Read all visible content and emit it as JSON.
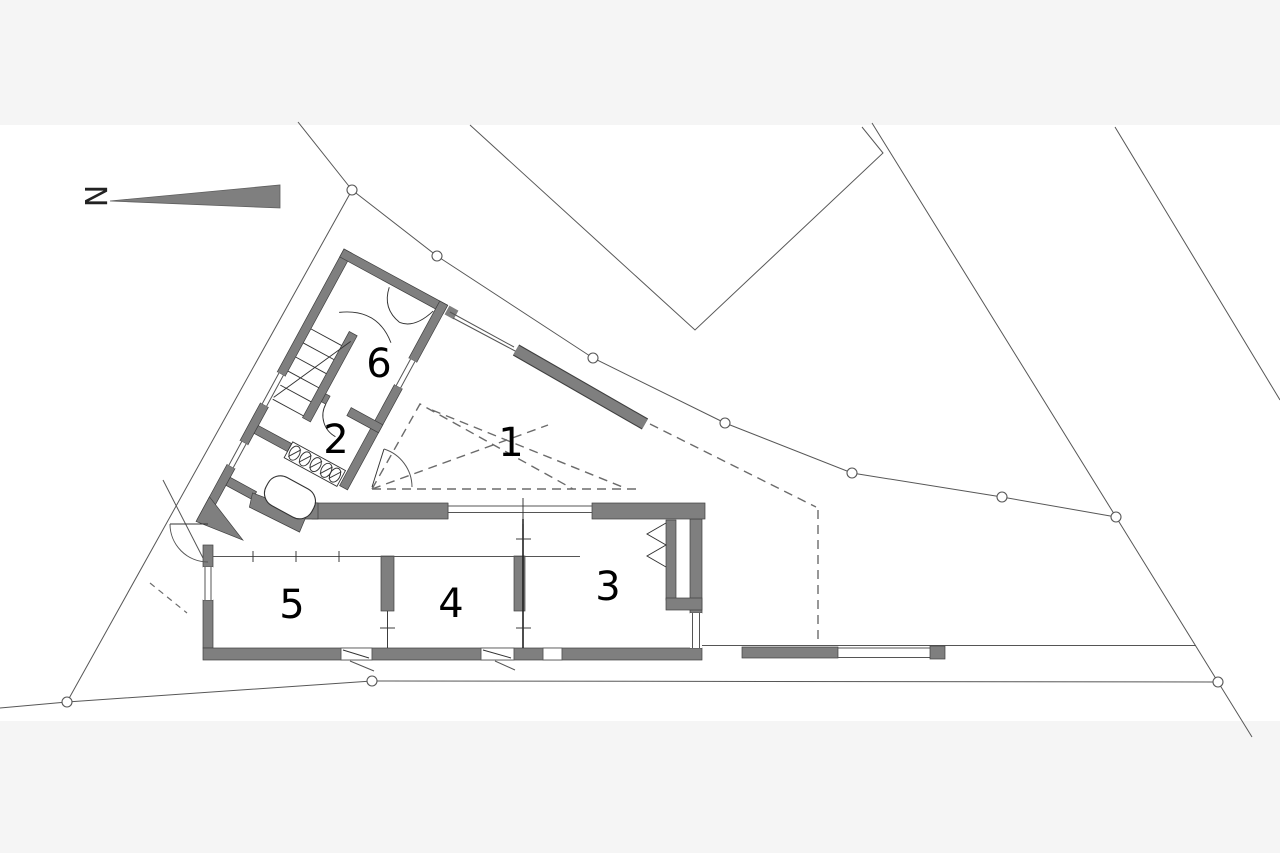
{
  "document": {
    "type": "architectural-site-and-floor-plan"
  },
  "north": {
    "label": "N"
  },
  "rooms": [
    {
      "label": "1",
      "x": 511,
      "y": 456
    },
    {
      "label": "2",
      "x": 336,
      "y": 453
    },
    {
      "label": "3",
      "x": 608,
      "y": 600
    },
    {
      "label": "4",
      "x": 451,
      "y": 617
    },
    {
      "label": "5",
      "x": 292,
      "y": 618
    },
    {
      "label": "6",
      "x": 379,
      "y": 377
    }
  ],
  "colors": {
    "paper": "#ffffff",
    "margin_band": "#f5f5f5",
    "wall_fill": "#7f7f7f",
    "wall_outline": "#3f3f3f",
    "line": "#555555",
    "dashed": "#6b6b6b",
    "label": "#000000"
  }
}
